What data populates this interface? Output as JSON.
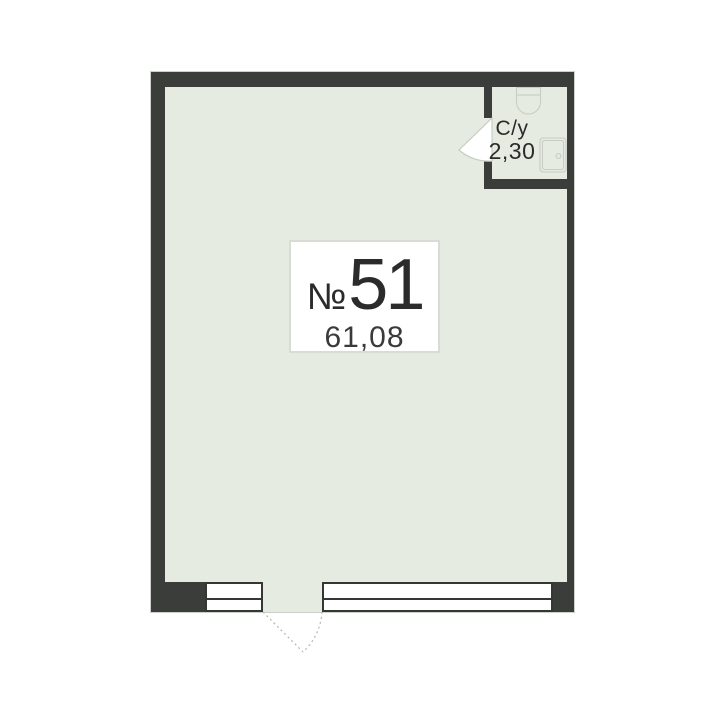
{
  "unit": {
    "number_sign": "№",
    "number": "51",
    "area": "61,08"
  },
  "bathroom": {
    "label": "С/у",
    "area": "2,30"
  },
  "colors": {
    "wall": "#3a3d3a",
    "floor": "#e5ebe1",
    "background": "#ffffff",
    "fixture_line": "#c7cdc4",
    "text": "#2b2b2b",
    "card_border": "#d8dcd5",
    "outer_hairline": "#ccd0cb",
    "divider": "#1e1e1e",
    "swing_dotted": "#b3b8b1"
  }
}
